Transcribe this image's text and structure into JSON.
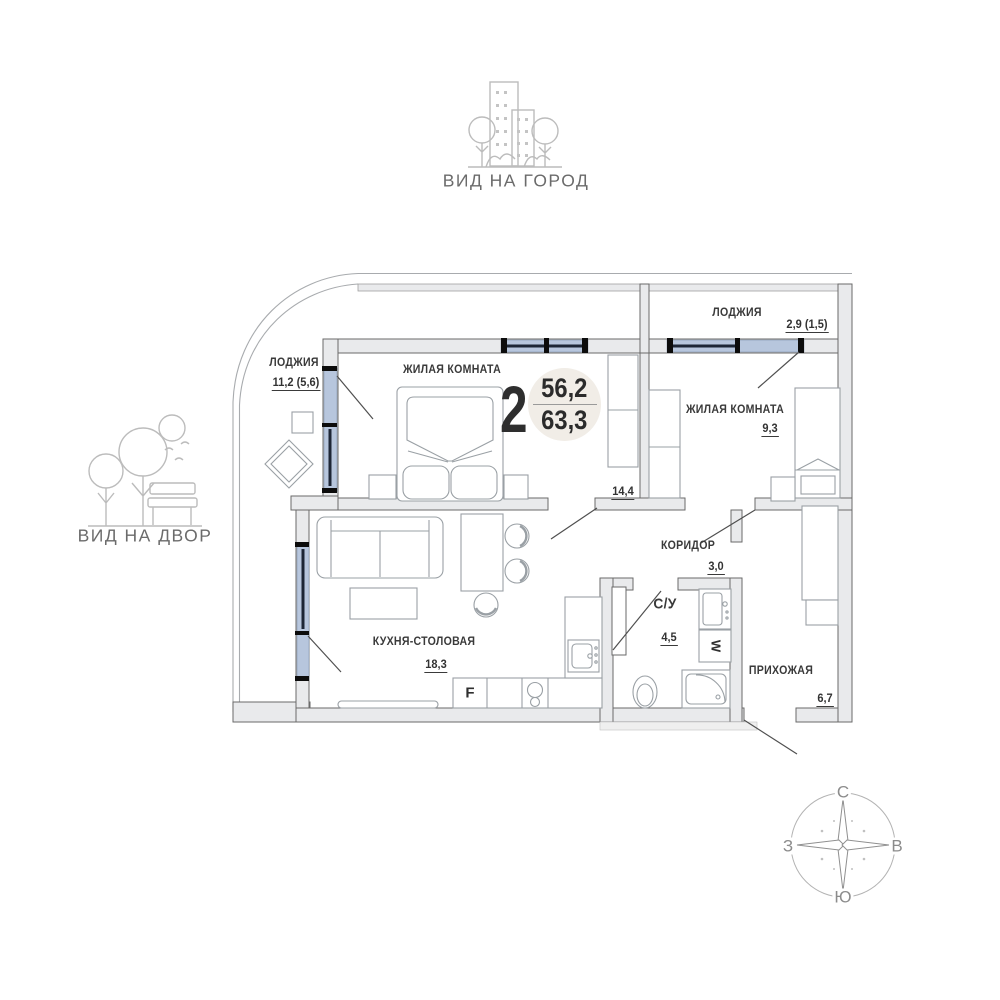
{
  "views": {
    "city": "ВИД НА ГОРОД",
    "yard": "ВИД НА ДВОР"
  },
  "floor_plan": {
    "badge": {
      "rooms_count": "2",
      "living_area": "56,2",
      "total_area": "63,3"
    },
    "rooms": {
      "loggia_left": {
        "name": "ЛОДЖИЯ",
        "area": "11,2 (5,6)"
      },
      "living_room_main": {
        "name": "ЖИЛАЯ КОМНАТА",
        "area": "14,4"
      },
      "loggia_top": {
        "name": "ЛОДЖИЯ",
        "area": "2,9 (1,5)"
      },
      "living_room_second": {
        "name": "ЖИЛАЯ КОМНАТА",
        "area": "9,3"
      },
      "corridor": {
        "name": "КОРИДОР",
        "area": "3,0"
      },
      "bathroom": {
        "name": "С/У",
        "area": "4,5"
      },
      "hallway": {
        "name": "ПРИХОЖАЯ",
        "area": "6,7"
      },
      "kitchen_dining": {
        "name": "КУХНЯ-СТОЛОВАЯ",
        "area": "18,3"
      }
    },
    "appliances": {
      "fridge": "F",
      "washer": "W"
    }
  },
  "compass": {
    "north": "С",
    "south": "Ю",
    "west": "З",
    "east": "В"
  },
  "colors": {
    "wall_fill": "#e9eaec",
    "window_glass": "#b7c6dd",
    "badge_circle": "#f1ede7",
    "icon_stroke": "#bcbcbc",
    "text": "#3a3a3a"
  }
}
